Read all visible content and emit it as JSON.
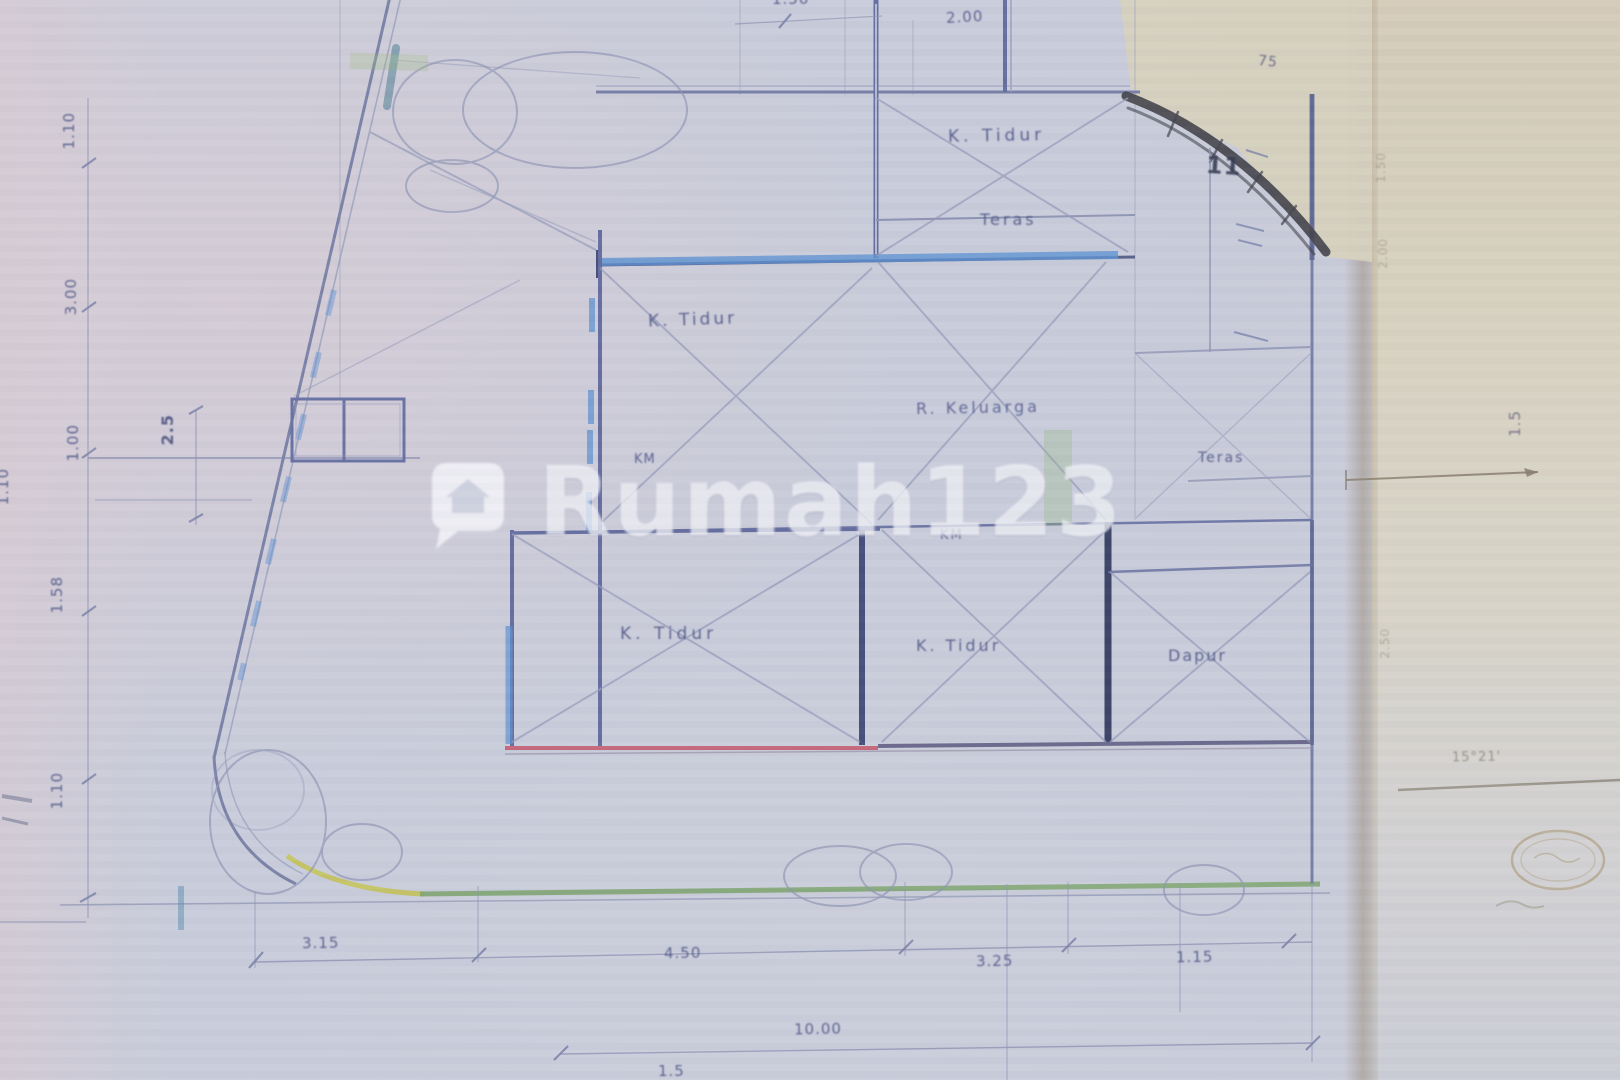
{
  "watermark": {
    "text": "Rumah123"
  },
  "rooms": {
    "bedroom_top": "K. Tidur",
    "terrace_top": "Teras",
    "bedroom_mid": "K. Tidur",
    "family_room": "R. Keluarga",
    "bath_small": "KM",
    "bath_center": "KM",
    "bedroom_bottom_left": "K. Tidur",
    "bedroom_bottom_center": "K. Tidur",
    "kitchen": "Dapur",
    "terrace_right": "Teras"
  },
  "dims": {
    "left_top": "1.10",
    "left_upper": "3.00",
    "left_small_a": "2.5",
    "left_small_b": "1.00",
    "far_left": "1.10",
    "left_lower": "1.58",
    "left_bottom": "1.10",
    "bottom_1": "3.15",
    "bottom_2": "4.50",
    "bottom_3": "3.25",
    "bottom_4": "1.15",
    "bottom_total": "10.00",
    "bottom_partial": "1.5",
    "top_a": "1.50",
    "top_b": "2.00",
    "top_right": "75",
    "right_rot": "1.5",
    "strip_a": "1.50",
    "strip_b": "2.00",
    "strip_c": "2.50"
  },
  "marks": {
    "section": "11",
    "angle_note": "15°21'"
  }
}
